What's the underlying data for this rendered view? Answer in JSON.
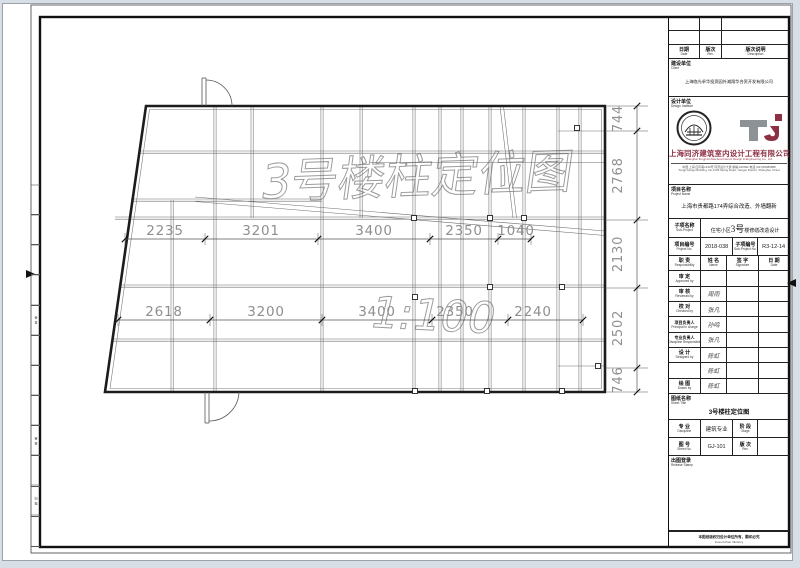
{
  "left_strip": {
    "items": [
      {
        "label": "会 签"
      },
      {
        "label": "审 核"
      },
      {
        "label": "归 档"
      }
    ]
  },
  "plan": {
    "watermark_title": "3号楼柱定位图",
    "watermark_scale": "1:100",
    "dims_top": [
      "2235",
      "3201",
      "3400",
      "2350",
      "1040"
    ],
    "dims_bottom": [
      "2618",
      "3200",
      "3400",
      "2350",
      "2240"
    ],
    "dims_right": [
      "744",
      "2768",
      "2130",
      "2502",
      "746"
    ]
  },
  "title_block": {
    "revision": {
      "date_zh": "日期",
      "date_en": "Date",
      "rev_zh": "版次",
      "rev_en": "Rev.",
      "desc_zh": "版次说明",
      "desc_en": "Description"
    },
    "client": {
      "label_zh": "建设单位",
      "label_en": "Client",
      "name": "上海临光卓华投资园外滩翔华合资开发有限公司"
    },
    "design_institute": {
      "label_zh": "设计单位",
      "label_en": "Design Institute",
      "name_zh": "上海同济建筑室内设计工程有限公司",
      "name_en": "Shanghai Tongji Architectural Interior Design & Engineering Co., Ltd.",
      "addr1": "中国 上海 四平路1239号 同济设计大厦 邮编:200092 电话:(021)65986888",
      "addr2": "Tongji Design Building, No.1239 Siping Road, Yangpu District, Shanghai, China"
    },
    "project": {
      "label_zh": "项目名称",
      "label_en": "Project Name",
      "name": "上海市贵都路174弄综合改造、外墙翻新"
    },
    "sub_project": {
      "label_zh": "子项名称",
      "label_en": "Sub-Project",
      "name_pre": "住宅小区",
      "name_big": "3号",
      "name_post": "楼修缮改造设计"
    },
    "numbers": {
      "project_no_zh": "项目编号",
      "project_no_en": "Project No.",
      "project_no": "2018-038",
      "sub_no_zh": "子项编号",
      "sub_no_en": "Sub-Project No.",
      "sub_no": "R3-12-14"
    },
    "personnel": {
      "headers": [
        {
          "zh": "职  责",
          "en": "Responsibility"
        },
        {
          "zh": "姓  名",
          "en": "Name"
        },
        {
          "zh": "签  字",
          "en": "Signature"
        },
        {
          "zh": "日  期",
          "en": "Date"
        }
      ],
      "rows": [
        {
          "zh": "审  定",
          "en": "Approved by",
          "name": ""
        },
        {
          "zh": "审  核",
          "en": "Reviewed by",
          "name": "周雨"
        },
        {
          "zh": "校  对",
          "en": "Checked by",
          "name": "张凡"
        },
        {
          "zh": "项目负责人",
          "en": "Principal in charge",
          "name": "孙鸣"
        },
        {
          "zh": "专业负责人",
          "en": "Discipline Responsible",
          "name": "张凡"
        },
        {
          "zh": "设  计",
          "en": "Designed by",
          "name": "陈虹"
        },
        {
          "zh": "",
          "en": "",
          "name": "陈虹"
        },
        {
          "zh": "绘  图",
          "en": "Drawn by",
          "name": "陈虹"
        }
      ]
    },
    "sheet": {
      "title_label_zh": "图纸名称",
      "title_label_en": "Sheet Title",
      "title": "3号楼柱定位图",
      "discipline_zh": "专  业",
      "discipline_en": "Discipline",
      "discipline": "建筑专业",
      "stage_zh": "阶  段",
      "stage_en": "Stage",
      "stage": "",
      "no_zh": "图  号",
      "no_en": "Sheet No.",
      "no": "GJ-101",
      "rev_zh": "版  次",
      "rev_en": "Rev.",
      "rev": ""
    },
    "release": {
      "label_zh": "出图登录",
      "label_en": "Release Stamp"
    },
    "footer": {
      "zh": "本图纸版权归设计单位所有，翻印必究",
      "en": "Invest Urban Vibrancy"
    }
  },
  "colors": {
    "accent_maroon": "#8e3044",
    "logo_gray": "#8d9297",
    "dim_gray": "#8f8f8f"
  }
}
